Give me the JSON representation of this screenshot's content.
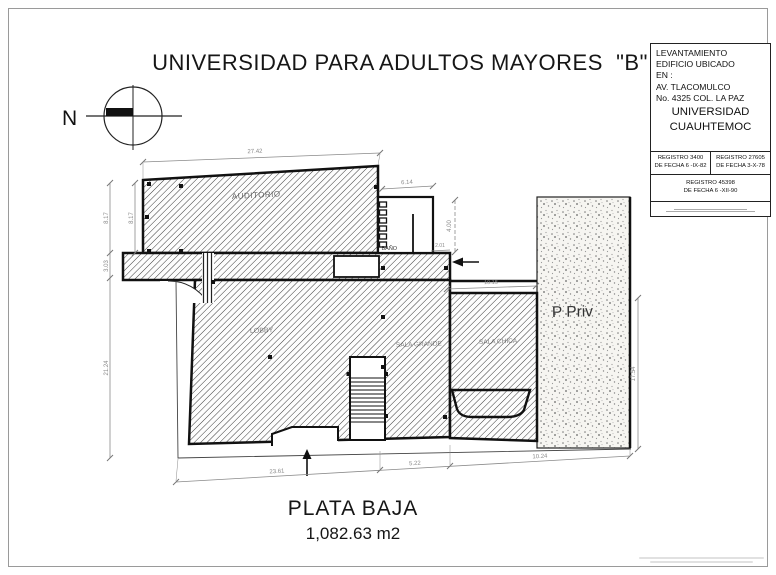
{
  "page": {
    "title": "UNIVERSIDAD PARA ADULTOS MAYORES  \"B\""
  },
  "north": {
    "label": "N"
  },
  "title_block": {
    "line1": "LEVANTAMIENTO",
    "line2": "EDIFICIO UBICADO",
    "line3": "EN :",
    "line4": "AV. TLACOMULCO",
    "line5": "No. 4325 COL. LA PAZ",
    "institution1": "UNIVERSIDAD",
    "institution2": "CUAUHTEMOC",
    "reg1_title": "REGISTRO 3400",
    "reg1_date": "DE FECHA 6 -IX-82",
    "reg2_title": "REGISTRO 27605",
    "reg2_date": "DE FECHA 3-X-78",
    "reg3_title": "REGISTRO 45398",
    "reg3_date": "DE FECHA 6 -XII-90"
  },
  "plan": {
    "rooms": {
      "auditorium": "AUDITORIO",
      "bath": "BAÑO",
      "lobby": "LOBBY",
      "sala_1": "SALA GRANDE",
      "sala_2": "SALA CHICA",
      "private_lot": "P Priv"
    },
    "dims": {
      "top_width": "27.42",
      "left_outer_upper": "8.17",
      "left_inner": "8.17",
      "left_outer_mid": "3.03",
      "left_outer_lower": "21.24",
      "bath_width": "6.14",
      "right_height": "4.00",
      "entry_width": "2.01",
      "upper_right_width": "10.15",
      "right_side_height": "17.54",
      "bottom_left": "23.61",
      "bottom_mid": "5.22",
      "bottom_right": "10.24"
    }
  },
  "footer": {
    "plan_name": "PLATA BAJA",
    "area": "1,082.63 m2"
  },
  "colors": {
    "wall": "#1a1a1a",
    "dimension": "#8a8a8a",
    "hatch_line": "#3a3a3a"
  }
}
